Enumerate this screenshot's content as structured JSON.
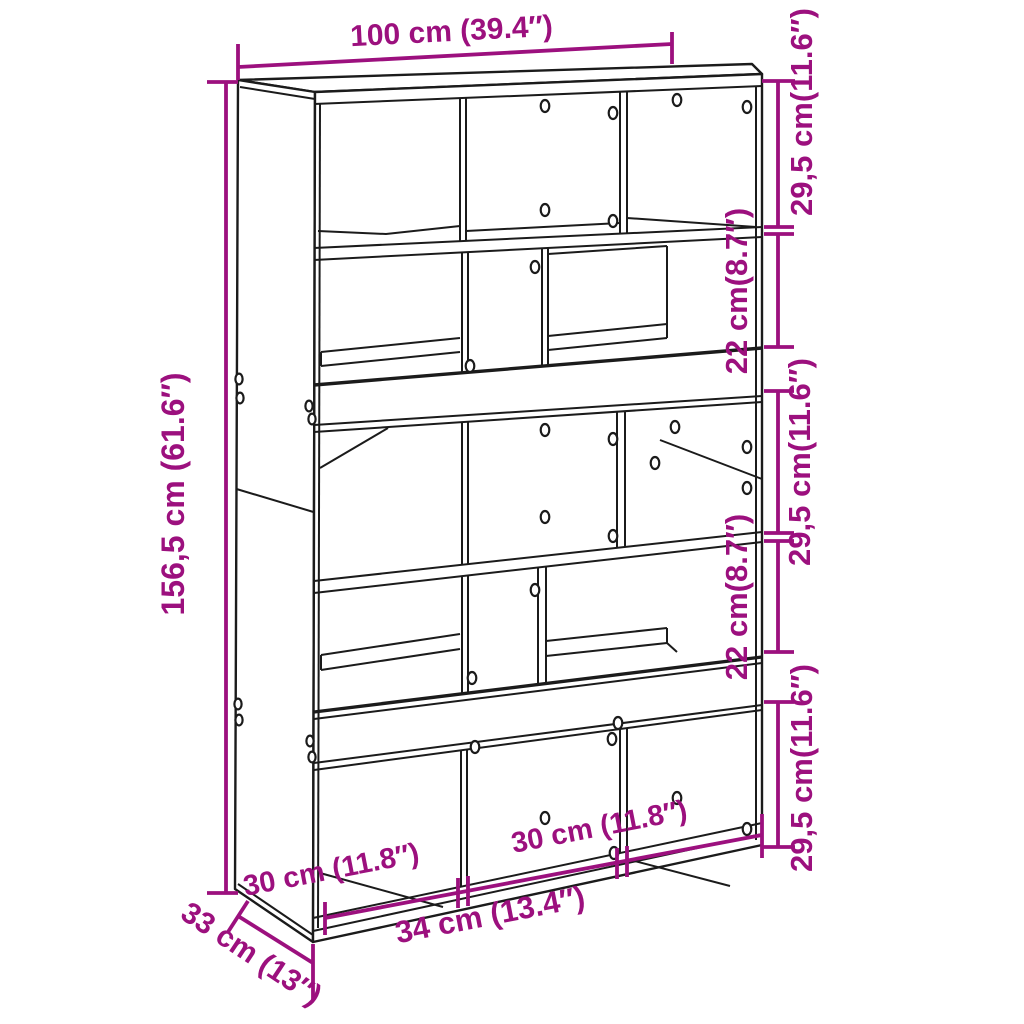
{
  "style": {
    "dimension_color": "#9C107E",
    "line_color": "#1b1b1b",
    "background": "#ffffff"
  },
  "dims": {
    "width": {
      "label": "100 cm (39.4″)"
    },
    "height": {
      "label": "156,5 cm (61.6″)"
    },
    "depth": {
      "label": "33 cm (13″)"
    },
    "right_sections": [
      {
        "label": "29,5 cm(11.6″)"
      },
      {
        "label": "22 cm(8.7″)"
      },
      {
        "label": "29,5 cm(11.6″)"
      },
      {
        "label": "22 cm(8.7″)"
      },
      {
        "label": "29,5 cm(11.6″)"
      }
    ],
    "bottom_sections": [
      {
        "label": "30 cm (11.8″)"
      },
      {
        "label": "34 cm (13.4″)"
      },
      {
        "label": "30 cm (11.8″)"
      }
    ]
  }
}
